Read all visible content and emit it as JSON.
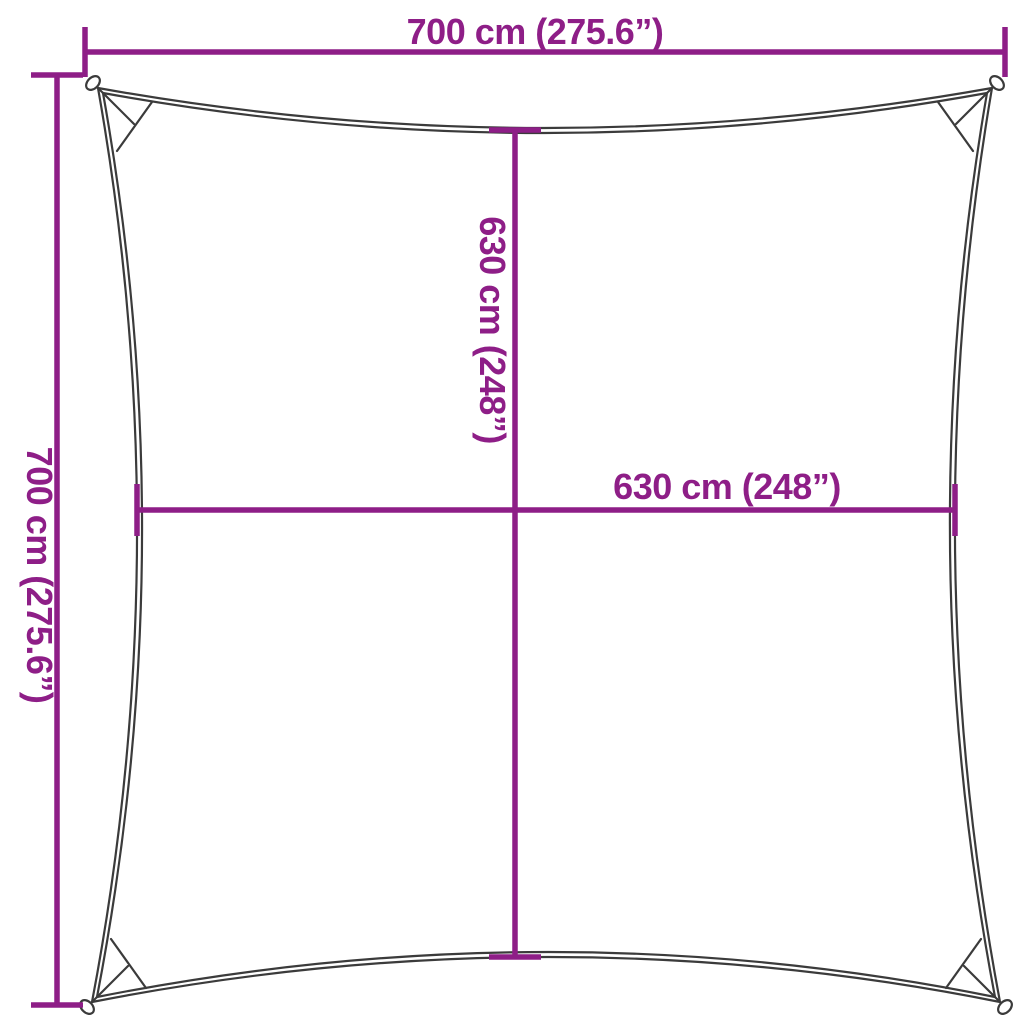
{
  "diagram": {
    "type": "product-dimension-diagram",
    "subject": "square shade sail with concave edges and corner rings"
  },
  "colors": {
    "dimension": "#8E1E87",
    "sail_outline": "#3B3B3B",
    "background": "#FFFFFF"
  },
  "labels": {
    "width_top": "700 cm (275.6”)",
    "height_left": "700 cm (275.6”)",
    "inner_height": "630 cm (248”)",
    "inner_width": "630 cm (248”)"
  }
}
